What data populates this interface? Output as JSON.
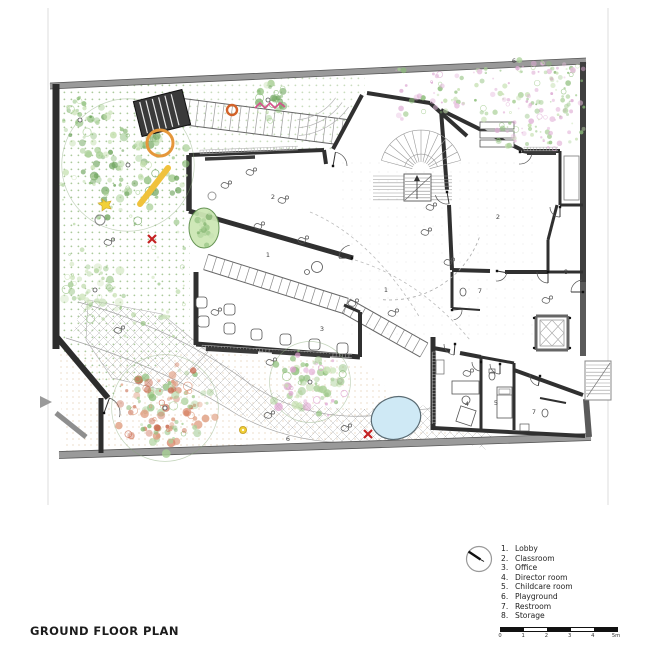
{
  "title": "GROUND FLOOR PLAN",
  "legend": {
    "items": [
      {
        "num": "1.",
        "label": "Lobby"
      },
      {
        "num": "2.",
        "label": "Classroom"
      },
      {
        "num": "3.",
        "label": "Office"
      },
      {
        "num": "4.",
        "label": "Director room"
      },
      {
        "num": "5.",
        "label": "Childcare room"
      },
      {
        "num": "6.",
        "label": "Playground"
      },
      {
        "num": "7.",
        "label": "Restroom"
      },
      {
        "num": "8.",
        "label": "Storage"
      }
    ]
  },
  "scale_bar": {
    "ticks": [
      "0",
      "1",
      "2",
      "3",
      "4",
      "5m"
    ]
  },
  "plan": {
    "room_labels": [
      {
        "num": "2",
        "x": 273,
        "y": 199
      },
      {
        "num": "2",
        "x": 498,
        "y": 219
      },
      {
        "num": "1",
        "x": 268,
        "y": 257
      },
      {
        "num": "1",
        "x": 386,
        "y": 292
      },
      {
        "num": "3",
        "x": 322,
        "y": 331
      },
      {
        "num": "7",
        "x": 480,
        "y": 293
      },
      {
        "num": "8",
        "x": 566,
        "y": 274
      },
      {
        "num": "4",
        "x": 467,
        "y": 406
      },
      {
        "num": "5",
        "x": 496,
        "y": 405
      },
      {
        "num": "7",
        "x": 534,
        "y": 414
      },
      {
        "num": "6",
        "x": 514,
        "y": 63
      },
      {
        "num": "6",
        "x": 288,
        "y": 441
      }
    ],
    "colors": {
      "pool": "#cfe9f5",
      "marker_red": "#c32222",
      "ring_orange": "#e5973a",
      "ring_orange_small": "#d2622a",
      "slide_yellow": "#f0c23c",
      "dot_yellow": "#f2d139",
      "zigzag_pink": "#d6508c",
      "foliage_green": "#8bbd78",
      "flower_pink": "#dca8d2",
      "flower_salmon": "#d9886b"
    }
  }
}
